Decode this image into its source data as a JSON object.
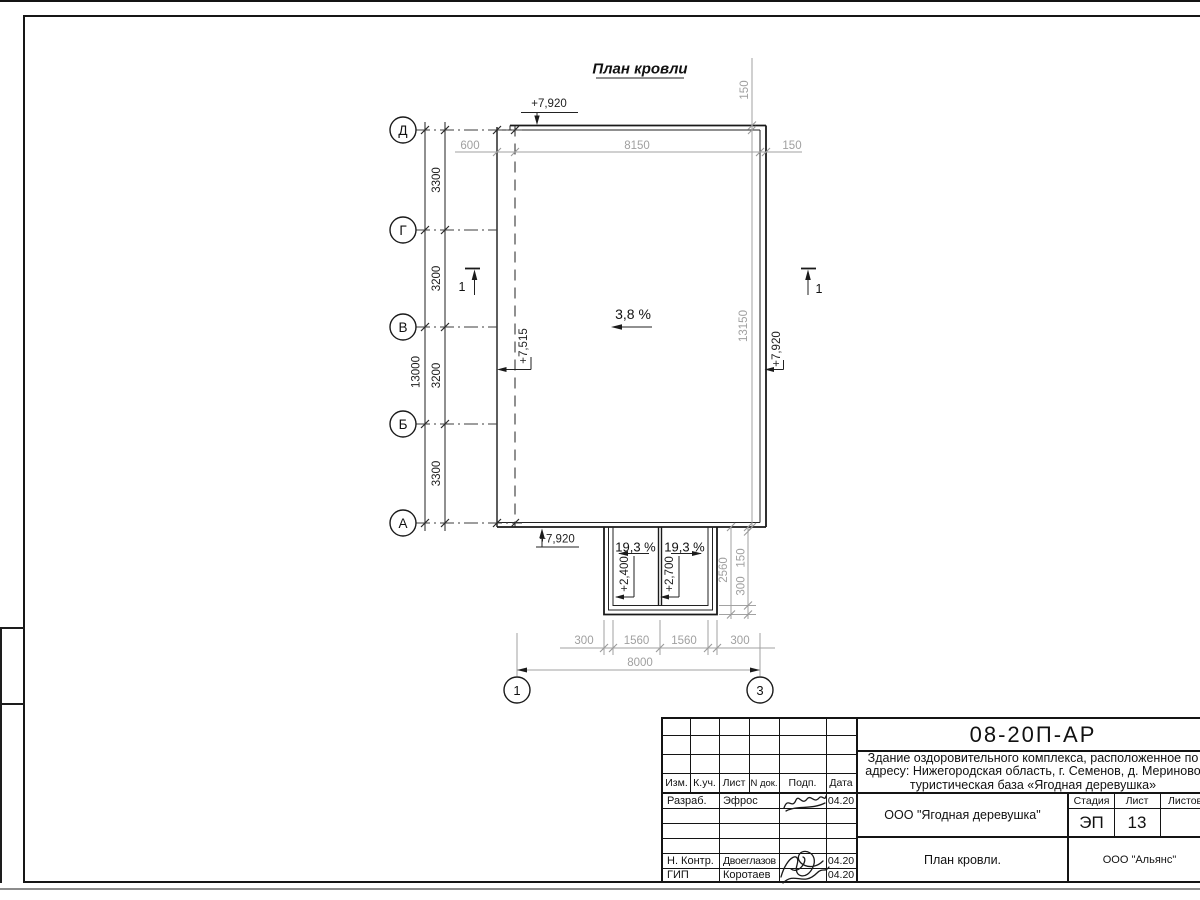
{
  "drawing": {
    "heading": "План кровли",
    "slope_main": "3,8 %",
    "canopy": {
      "slope_left": "19,3 %",
      "slope_right": "19,3 %",
      "elev_left": "+2,400",
      "elev_right": "+2,700"
    },
    "elevations": {
      "top": "+7,920",
      "bottom": "+7,920",
      "left": "+7,515",
      "right": "+7,920"
    },
    "section": {
      "left": "1",
      "right": "1"
    },
    "axes_left": [
      "Д",
      "Г",
      "В",
      "Б",
      "А"
    ],
    "axes_bottom": [
      "1",
      "3"
    ],
    "dims": {
      "top_600": "600",
      "top_8150": "8150",
      "top_150": "150",
      "v150": "150",
      "v13150": "13150",
      "total_v": "13000",
      "seg_dg": "3300",
      "seg_gv": "3200",
      "seg_vb": "3200",
      "seg_ba": "3300",
      "canopy_2560": "2560",
      "canopy_150": "150",
      "canopy_300": "300",
      "b300l": "300",
      "b1560l": "1560",
      "b1560r": "1560",
      "b300r": "300",
      "b8000": "8000"
    }
  },
  "titleblock": {
    "doc_number": "08-20П-АР",
    "project_line1": "Здание оздоровительного комплекса, расположенное по",
    "project_line2": "адресу: Нижегородская область, г. Семенов, д. Мериново",
    "project_line3": "туристическая база «Ягодная деревушка»",
    "header_cols": [
      "Изм.",
      "К.уч.",
      "Лист",
      "N док.",
      "Подп.",
      "Дата"
    ],
    "rows": [
      {
        "role": "Разраб.",
        "name": "Эфрос",
        "date": "04.20"
      },
      {
        "role": "Н. Контр.",
        "name": "Двоеглазов",
        "date": "04.20"
      },
      {
        "role": "ГИП",
        "name": "Коротаев",
        "date": "04.20"
      }
    ],
    "client": "ООО \"Ягодная деревушка\"",
    "sheet_title": "План кровли.",
    "org": "ООО \"Альянс\"",
    "stage_label": "Стадия",
    "sheet_label": "Лист",
    "sheets_label": "Листов",
    "stage": "ЭП",
    "sheet_num": "13"
  }
}
